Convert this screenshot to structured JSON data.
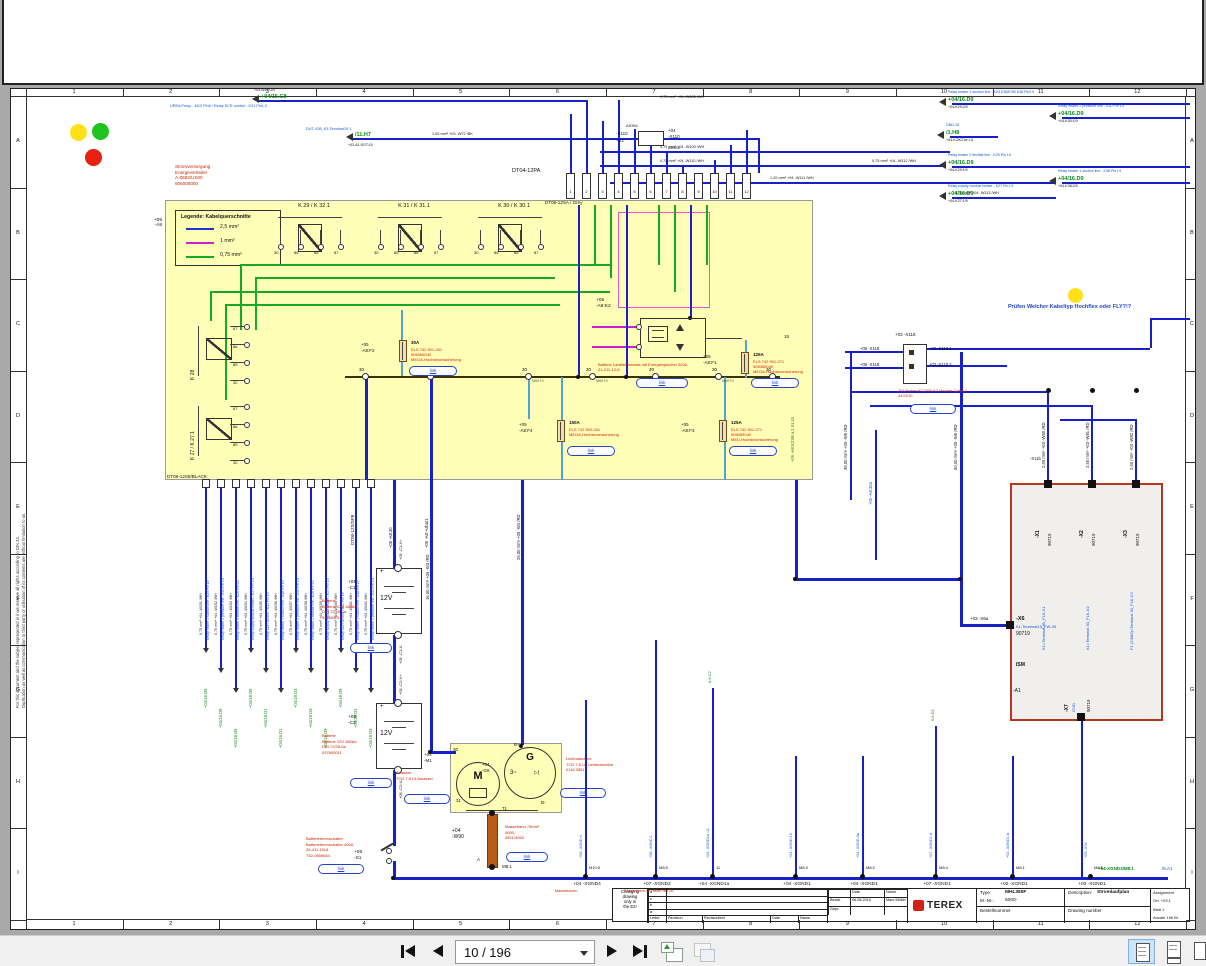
{
  "viewer": {
    "toolbar": {
      "page_combo": "10 / 196",
      "buttons": {
        "first": "first-page",
        "prev": "previous-page",
        "next": "next-page",
        "last": "last-page"
      },
      "window_icons": [
        "detach-page",
        "duplicate-window"
      ],
      "layout_icons": [
        "single-page",
        "continuous",
        "two-page"
      ]
    }
  },
  "frame": {
    "columns": [
      "1",
      "2",
      "3",
      "4",
      "5",
      "6",
      "7",
      "8",
      "9",
      "10",
      "11",
      "12"
    ],
    "rows": [
      "A",
      "B",
      "C",
      "D",
      "E",
      "F",
      "G",
      "H",
      "I"
    ],
    "disclaimer": [
      "For this document and the subject represented in it we reserve all rights according to DIN 34.",
      "Duplication as well as communication to third party or utilisation of its contents are without limitation to us."
    ]
  },
  "notes": {
    "red_block": [
      "Stromversorgung",
      "Energieverteiler",
      "A-0682/US00",
      "506000000"
    ],
    "check_note": "Prüfen Welcher Kabeltyp Hochflex oder FLY?!?"
  },
  "connector_labels": {
    "dt04": "DT04-12PA",
    "dt06_grey": "DT06-12SA / Grey",
    "dt06_black": "DT06-12S8/BLACK",
    "dt06_sp": "DT06-12S/SP8",
    "x110": "-X110",
    "x110_left": "+03",
    "x110_right": "+04",
    "a3ob4": "A3OB4",
    "pins": [
      "1",
      "2",
      "3",
      "4",
      "5",
      "6",
      "7",
      "8",
      "9",
      "10",
      "11",
      "12"
    ]
  },
  "legend": {
    "tag": [
      "+05",
      "-A8"
    ],
    "title": "Legende: Kabelquerschnitte",
    "items": [
      {
        "label": "2,5 mm²",
        "color": "#2233cc"
      },
      {
        "label": "1 mm²",
        "color": "#cc22cc"
      },
      {
        "label": "0,75 mm²",
        "color": "#11aa22"
      }
    ]
  },
  "relays": {
    "top": [
      "K 29 / K 32.1",
      "K 31 / K 31.1",
      "K 30 / K 30.1"
    ],
    "left": [
      "K 28",
      "K 27 / K 27.1"
    ],
    "pins": [
      "30",
      "85",
      "86",
      "87"
    ],
    "pins_left": [
      "87",
      "86",
      "85",
      "30"
    ]
  },
  "bus": {
    "node": "30",
    "stud": "M6KT0"
  },
  "fuses": [
    {
      "tag": [
        "+05",
        "-A8:F2"
      ],
      "amp": "30A",
      "red": [
        "ELS 742 901-001",
        "505065040",
        "MEGA-Hochstromsicherung"
      ]
    },
    {
      "tag": [
        "+05",
        "-A8:F1"
      ],
      "amp": "125A",
      "red": [
        "ELS 742 901-071",
        "505065040",
        "MEGA-Hochstromsicherung"
      ]
    },
    {
      "tag": [
        "+05",
        "-A8:F4"
      ],
      "amp": "150A",
      "red": [
        "ELS 742 902-001",
        "MEGA-Hochstromsicherung"
      ]
    },
    {
      "tag": [
        "+05",
        "-A8:F3"
      ],
      "amp": "125A",
      "red": [
        "ELS 742 901-071",
        "505065040",
        "MED-Hochstromsicherung"
      ]
    }
  ],
  "k2": {
    "tag": [
      "+05",
      "-A8:K2"
    ],
    "red": [
      "Batterie Ladetrennrelais mit Energiespeicher 200A",
      "21-211-12-6"
    ],
    "kl15": "+05 -A8:K2:86 a.1  KL15",
    "pin15": "15"
  },
  "link_label": "link",
  "x118": {
    "top": "+03 -X118",
    "left": [
      "+05 -X118",
      "+05 -X118"
    ],
    "right": [
      "+03 -X118.1",
      "+03 -X118.2"
    ],
    "red": [
      "2W Power HC2400 K3 Header Cable 1",
      "44/2010"
    ]
  },
  "batteries": [
    {
      "tag": [
        "+05",
        "-C1"
      ],
      "volt": "12V",
      "top": "+05 -C1:X+",
      "bottom": "+05 -C1:X-",
      "red": [
        "Batterie",
        "Batterie 12V 180Ah",
        "DIN 72/28-6a",
        "537800011"
      ]
    },
    {
      "tag": [
        "+05",
        "-C2"
      ],
      "volt": "12V",
      "top": "+05 -C2:X+",
      "bottom": "+05 -C2:X-",
      "red": [
        "Batterie",
        "Batterie 12V 180Ah",
        "DIN 72/28-6a",
        "537800011"
      ]
    }
  ],
  "s1": {
    "tag": [
      "+05",
      "-S1"
    ],
    "red": [
      "Batterietrennschalter",
      "Batterietrennschalter 400A",
      "26-411-10L8",
      "T52-0655684"
    ]
  },
  "starter": {
    "tag": [
      "+04",
      "-M1"
    ],
    "m": "M",
    "p30": "30",
    "p31": "31",
    "red": [
      "Anlasser",
      "TCD 7.8 L6 Anlasser"
    ]
  },
  "alternator": {
    "tag": [
      "+04",
      "-G6"
    ],
    "g": "G",
    "three": "3~",
    "diode": "▷|",
    "bplus": "B+",
    "bminus": "B-",
    "red": [
      "Lichtmaschine",
      "TCD 7.8 L6 Lichtmaschine",
      "0118 3851"
    ]
  },
  "masseband": {
    "tag": [
      "+04",
      "-W90"
    ],
    "t1": "T1",
    "a": "A",
    "m81": "M8:1",
    "red": [
      "Masseband 70mm²",
      "0000-",
      "0821/4063"
    ]
  },
  "module": {
    "top": [
      {
        "name": "-X1",
        "code": "90719",
        "desc": "K1=Terminal 30_FLK-X1"
      },
      {
        "name": "-X2",
        "code": "90719",
        "desc": "K1=Terminal 30_FLK-X2"
      },
      {
        "name": "-X3",
        "code": "90719",
        "desc": "F1 (X4/86)=Terminal 30_FLK-X3"
      }
    ],
    "left": {
      "name": "-X6",
      "code": "90719",
      "desc": "K1-Terminal15_FW-X6",
      "outside": "+03 -X6a"
    },
    "bottom": {
      "name": "-X7",
      "code": "90719",
      "desc": "GND"
    },
    "inner": [
      "ISM",
      "-A1"
    ]
  },
  "top_left_links": [
    {
      "green": "+04/15.C8",
      "small": "+04-W11:GN",
      "blue": "UREA Pump - M10 Pin5 / Relay SCR control - K31 Pin1.0"
    },
    {
      "green": "/11.H7",
      "blue": "DUT-41B_K3-Terminal15.1",
      "small": "+03-A1:SGT:15"
    }
  ],
  "top_right_links": [
    {
      "green": "+04/16.D9",
      "blue": "Relay heater 1 suction line - K29 K38/K3M K38 Pin2.9",
      "small": "+04-K29:2/9"
    },
    {
      "green": "+04/16.D9",
      "blue": "Relay heater 2 pressure line - K30 Pin L9",
      "small": "+04-K30:1/9"
    },
    {
      "green": "/1.H8",
      "blue": "GND-15",
      "small": "+04-K2/K21a:1.6"
    },
    {
      "green": "+04/16.D9",
      "blue": "Relay heater 2 flexible line - K29 Pin L9",
      "small": "+04-K29:1/9"
    },
    {
      "green": "+04/16.D9",
      "blue": "Relay heater 1 suction line - K38 Pin L9",
      "small": "+04-K38:2/9"
    },
    {
      "green": "+04/16.D9",
      "blue": "Relay supply module heater - K27 Pin L9",
      "small": "+04-K27:1/9"
    }
  ],
  "gauge_labels": [
    "0,75 mm² +04 -W105 /WH",
    "0,75 mm² +04 -W109 /WH",
    "1,00 mm² +03 -W72 /BK",
    "0,75 mm² +04 -W110 /WH",
    "1,20 mm² +04 -W111 /WH",
    "0,75 mm² +04 -W112 /WH",
    "0,75 mm² +04 -W113 /WH"
  ],
  "fan": {
    "gauges": [
      "0,75 mm² +04 -W151 /WH",
      "0,75 mm² +04 -W152 /WH",
      "0,75 mm² +04 -W153 /WH",
      "0,75 mm² +04 -W154 /WH",
      "0,75 mm² +04 -W155 /WH",
      "0,75 mm² +04 -W156 /WH",
      "0,75 mm² +04 -W157 /WH",
      "0,75 mm² +04 -W158 /WH",
      "0,75 mm² +04 -W159 /WH",
      "0,75 mm² +04 -W160 /WH",
      "0,75 mm² +04 -W161 /WH",
      "0,75 mm² +04 -W162 /WH"
    ],
    "targets": [
      "+04/16.D9",
      "+04/16.D9",
      "+04/18.D9",
      "+04/18.D9",
      "+04/19.D1",
      "+04/19.D1",
      "+04/19.D3",
      "+04/19.D3",
      "+04/16.D9",
      "+04/18.D9",
      "+04/19.D1",
      "+04/19.D3"
    ],
    "descs": [
      "Relay heater 1 suction line - K29 Pin L9",
      "Relay heater 2 pressure line - K30 Pin L9",
      "Relay heater 2 flexible line - K29 Pin L9",
      "Relay supply module heater - K27 Pin L9",
      "Relay SCR control - K31 Pin L9",
      "Relay heater 1 suction line - K38 Pin L9",
      "Relay heater 2 pressure line - K30 Pin L9",
      "Relay heater 2 flexible line - K29 Pin L9",
      "Relay supply module heater - K27 Pin L9",
      "Relay SCR control - K31 Pin L9",
      "Relay heater 1 suction line - K38 Pin L9",
      "Relay heater 2 pressure line - K30 Pin L9"
    ]
  },
  "right_labels": [
    "35,00 mm² +05 -W5 /RD",
    "+05 -A8:30a",
    "50,00 mm² +05 -W6 /RD",
    "2,50 mm² +03 -W80 /RD",
    "2,50 mm² +03 -W81 /RD",
    "2,50 mm² +03 -W82 /RD",
    "-X11b"
  ],
  "center_labels": [
    "+05 -A8:+Ubat1",
    "+05 -A8:30",
    "25,00 mm² +05 -W4 /RD",
    "16,00 mm² +05 -W3 /RD"
  ],
  "grounds": {
    "points": [
      {
        "bolt": "M10:5",
        "tag": "+04 -XGND4",
        "red": "Massebolzen",
        "wire": "+05 -XGND:4"
      },
      {
        "bolt": "M8:5",
        "tag": "+07 -XGND2",
        "red": "Masseblech im Halter der ZE",
        "wire": "+06 -XGND:1"
      },
      {
        "bolt": "11",
        "tag": "+04 -XGND1a",
        "red": "",
        "wire": "+04 -XGND1a :11"
      },
      {
        "bolt": "M8:3",
        "tag": "+04 -XGND1",
        "red": "",
        "wire": "+04 -XGND:10"
      },
      {
        "bolt": "M8:2",
        "tag": "+04 -XGND1",
        "red": "",
        "wire": "+04 -XGND:3a"
      },
      {
        "bolt": "M8:4",
        "tag": "+07 -XGND1",
        "red": "",
        "wire": "+07 -XGND1:d"
      },
      {
        "bolt": "M8:1",
        "tag": "+02 -XGND1",
        "red": "",
        "wire": "+02 -XGND1:b"
      },
      {
        "bolt": "M8:1",
        "tag": "+03 -XGND1",
        "red": "",
        "wire": "+03 -X7a"
      }
    ],
    "green_stubs": [
      "/L6.C2",
      "/L6.D2"
    ],
    "right_green": "+04-XGND3/M8.1",
    "right_blue": "/5.A1"
  },
  "titleblock": {
    "change_note": [
      "Changing",
      "drawing",
      "only in",
      "the E2!"
    ],
    "rev_rows": [
      "d",
      "c",
      "b",
      "a"
    ],
    "rev_headers": [
      "Letter",
      "Revision",
      "Revisiontext",
      "Date",
      "Name"
    ],
    "sign": {
      "date_header": "Date",
      "name_header": "Name",
      "rows": [
        {
          "role": "Bearb.",
          "date": "06.08.2010",
          "name": "Marc Müller"
        },
        {
          "role": "Gepr.",
          "date": "",
          "name": ""
        }
      ]
    },
    "brand": "TEREX",
    "type_label": "Type:",
    "type_value": "MHL360F",
    "mnr_label": "M.-Nr.:",
    "mnr_value": "5000-",
    "desc_label": "Description:",
    "desc_value": "Stromlaufplan",
    "bestell": "Bestellnummer",
    "drawing": "Drawing number",
    "assignment": "Assignment",
    "ort": "Ort. +03.1",
    "blatt": "Blatt 1",
    "anzahl": "Anzahl 196 Bl."
  }
}
